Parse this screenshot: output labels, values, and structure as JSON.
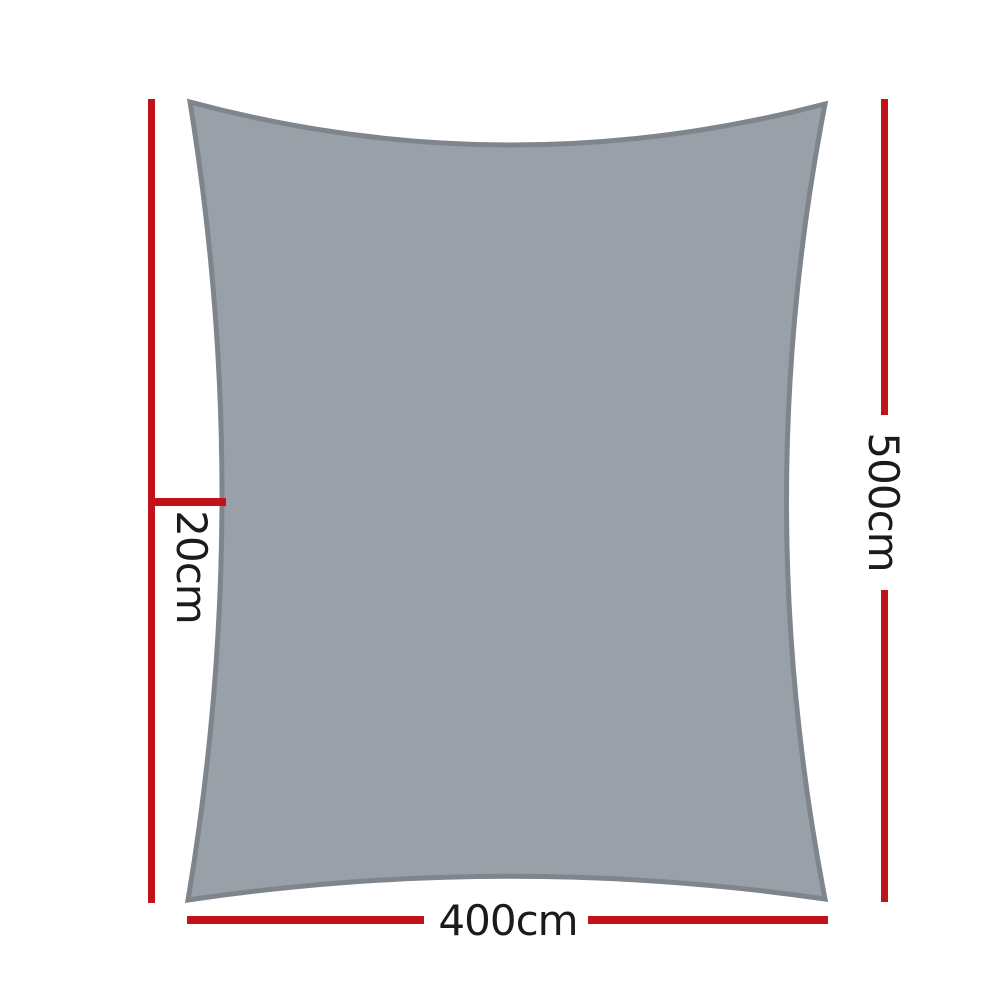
{
  "diagram": {
    "sail_shape": "rectangle-shade-sail-silhouette",
    "dimension_labels": {
      "offset": "20cm",
      "height": "500cm",
      "width": "400cm"
    }
  },
  "colors": {
    "dimension_line": "#c1121a",
    "sail_fill": "#99a0a8",
    "sail_border": "#7f858c",
    "label_text": "#1b1b1b",
    "background": "#ffffff"
  }
}
